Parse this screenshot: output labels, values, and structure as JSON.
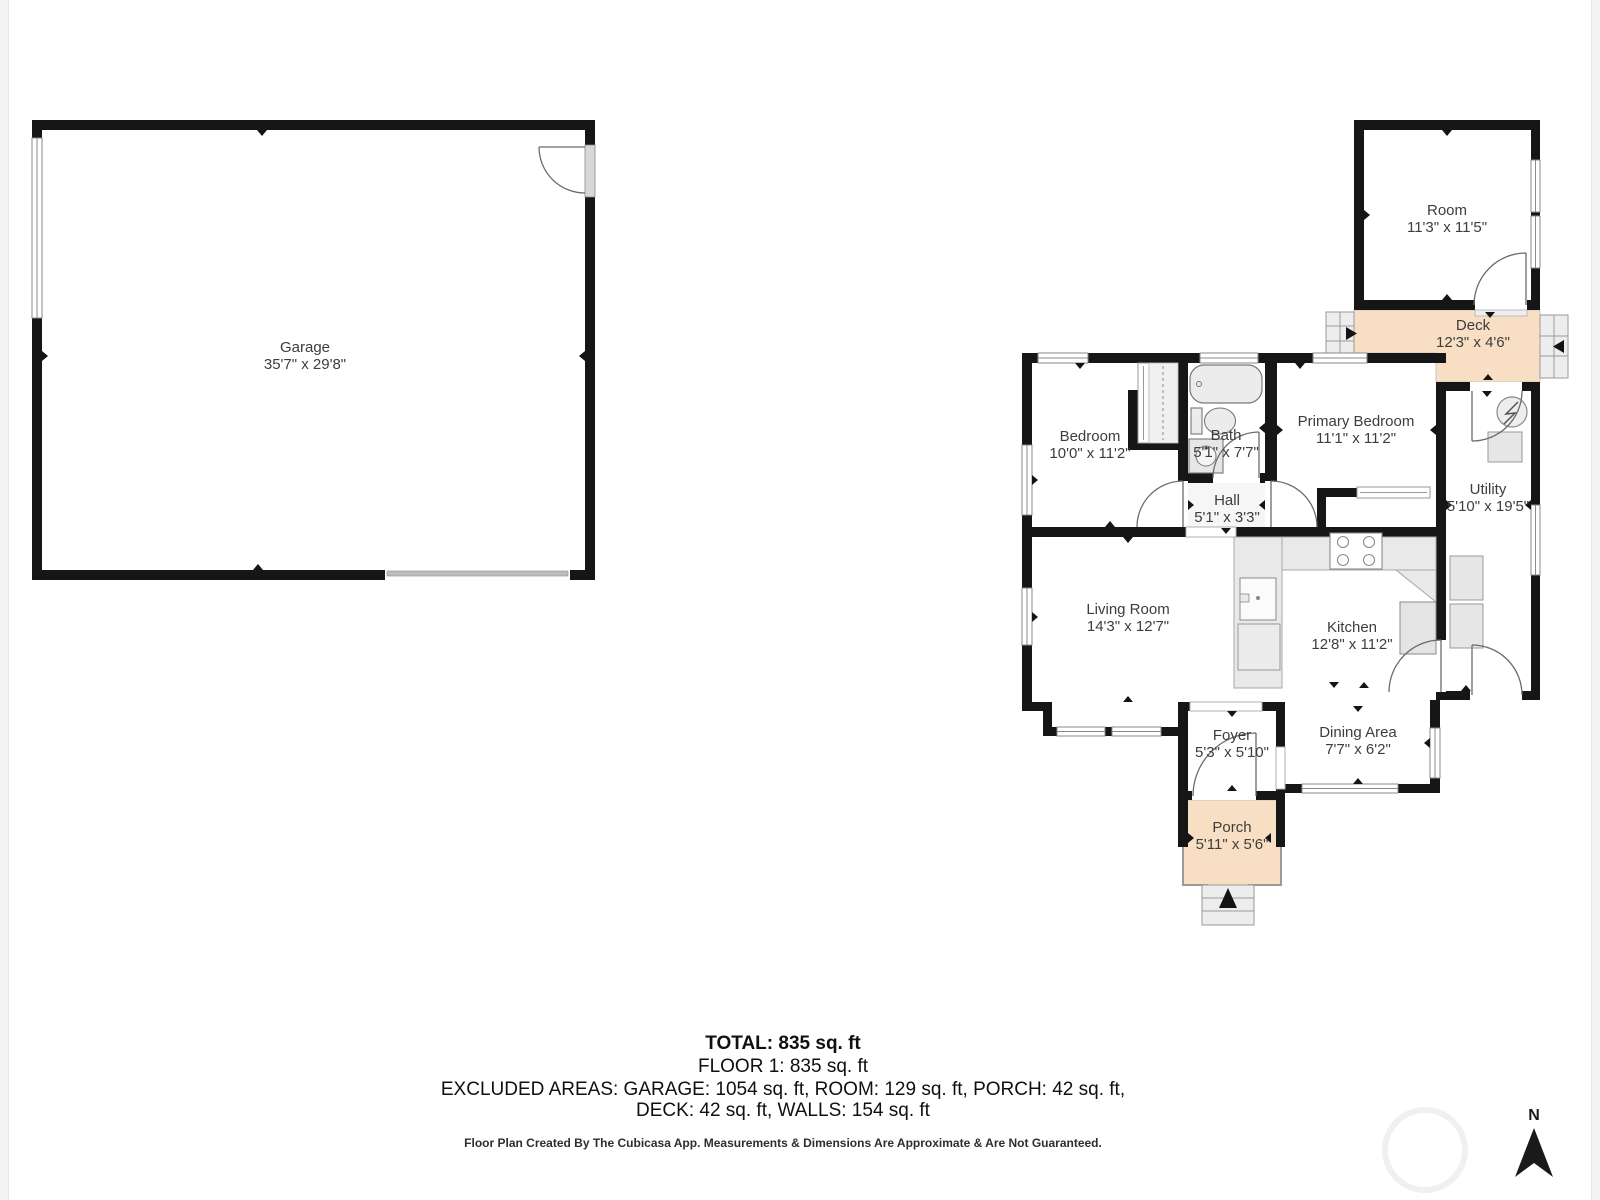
{
  "rooms": [
    {
      "id": "garage",
      "name": "Garage",
      "dims": "35'7\" x 29'8\""
    },
    {
      "id": "room",
      "name": "Room",
      "dims": "11'3\" x 11'5\""
    },
    {
      "id": "deck",
      "name": "Deck",
      "dims": "12'3\" x 4'6\""
    },
    {
      "id": "bedroom",
      "name": "Bedroom",
      "dims": "10'0\" x 11'2\""
    },
    {
      "id": "bath",
      "name": "Bath",
      "dims": "5'1\" x 7'7\""
    },
    {
      "id": "primary-bedroom",
      "name": "Primary Bedroom",
      "dims": "11'1\" x 11'2\""
    },
    {
      "id": "hall",
      "name": "Hall",
      "dims": "5'1\" x 3'3\""
    },
    {
      "id": "utility",
      "name": "Utility",
      "dims": "5'10\" x 19'5\""
    },
    {
      "id": "living-room",
      "name": "Living Room",
      "dims": "14'3\" x 12'7\""
    },
    {
      "id": "kitchen",
      "name": "Kitchen",
      "dims": "12'8\" x 11'2\""
    },
    {
      "id": "foyer",
      "name": "Foyer",
      "dims": "5'3\" x 5'10\""
    },
    {
      "id": "dining-area",
      "name": "Dining Area",
      "dims": "7'7\" x 6'2\""
    },
    {
      "id": "porch",
      "name": "Porch",
      "dims": "5'11\" x 5'6\""
    }
  ],
  "summary": {
    "total": "TOTAL: 835 sq. ft",
    "floor1": "FLOOR 1: 835 sq. ft",
    "excluded_line1": "EXCLUDED AREAS: GARAGE: 1054 sq. ft, ROOM: 129 sq. ft, PORCH: 42 sq. ft,",
    "excluded_line2": "DECK: 42 sq. ft, WALLS: 154 sq. ft"
  },
  "footer": {
    "disclaimer": "Floor Plan Created By The Cubicasa App. Measurements & Dimensions Are Approximate & Are Not Guaranteed."
  },
  "compass": {
    "label": "N"
  },
  "colors": {
    "wall": "#161616",
    "outdoor_fill": "#f8dfc3",
    "counter_fill": "#e9e9e9",
    "fixture_fill": "#ececec",
    "label_text": "#3d3d3d"
  }
}
